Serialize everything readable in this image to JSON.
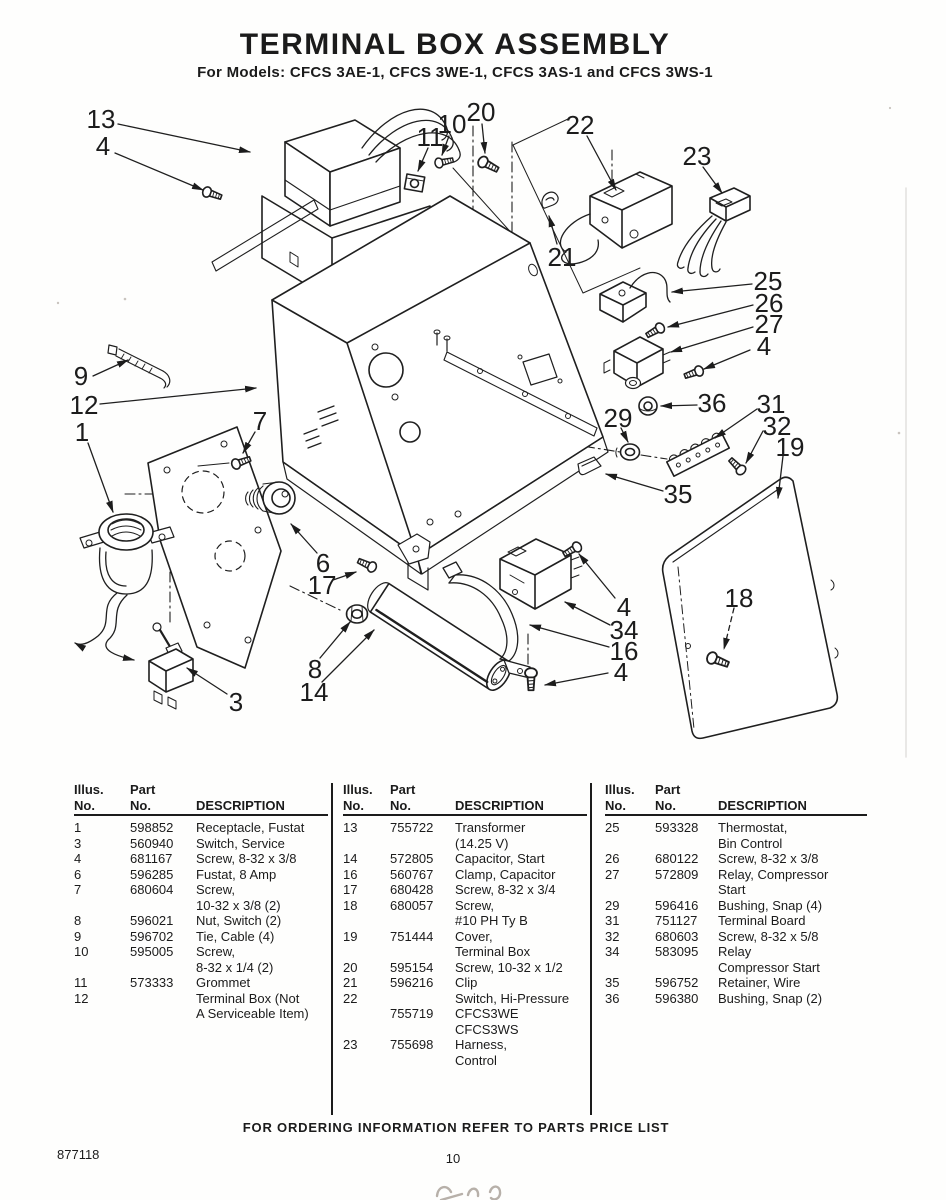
{
  "page": {
    "title": "TERMINAL BOX ASSEMBLY",
    "subtitle": "For Models: CFCS 3AE-1, CFCS 3WE-1, CFCS 3AS-1 and CFCS 3WS-1",
    "ordering_note": "FOR ORDERING INFORMATION REFER TO PARTS PRICE LIST",
    "doc_number": "877118",
    "page_number": "10"
  },
  "diagram": {
    "callouts": [
      "13",
      "4",
      "11",
      "10",
      "20",
      "22",
      "23",
      "21",
      "25",
      "26",
      "27",
      "4",
      "9",
      "12",
      "1",
      "7",
      "29",
      "36",
      "31",
      "32",
      "19",
      "35",
      "6",
      "17",
      "8",
      "14",
      "3",
      "4",
      "34",
      "16",
      "4",
      "18"
    ]
  },
  "table_headers": {
    "illus": "Illus.\nNo.",
    "part": "Part\nNo.",
    "desc": "DESCRIPTION"
  },
  "tables": [
    {
      "rows": [
        {
          "illus": "1",
          "part": "598852",
          "desc": "Receptacle, Fustat"
        },
        {
          "illus": "3",
          "part": "560940",
          "desc": "Switch, Service"
        },
        {
          "illus": "4",
          "part": "681167",
          "desc": "Screw, 8-32 x 3/8"
        },
        {
          "illus": "6",
          "part": "596285",
          "desc": "Fustat, 8 Amp"
        },
        {
          "illus": "7",
          "part": "680604",
          "desc": "Screw,\n10-32 x 3/8 (2)"
        },
        {
          "illus": "8",
          "part": "596021",
          "desc": "Nut, Switch (2)"
        },
        {
          "illus": "9",
          "part": "596702",
          "desc": "Tie, Cable (4)"
        },
        {
          "illus": "10",
          "part": "595005",
          "desc": "Screw,\n8-32 x 1/4 (2)"
        },
        {
          "illus": "11",
          "part": "573333",
          "desc": "Grommet"
        },
        {
          "illus": "12",
          "part": "",
          "desc": "Terminal Box (Not\nA Serviceable Item)"
        }
      ]
    },
    {
      "rows": [
        {
          "illus": "13",
          "part": "755722",
          "desc": "Transformer\n(14.25 V)"
        },
        {
          "illus": "14",
          "part": "572805",
          "desc": "Capacitor, Start"
        },
        {
          "illus": "16",
          "part": "560767",
          "desc": "Clamp, Capacitor"
        },
        {
          "illus": "17",
          "part": "680428",
          "desc": "Screw, 8-32 x 3/4"
        },
        {
          "illus": "18",
          "part": "680057",
          "desc": "Screw,\n#10 PH Ty B"
        },
        {
          "illus": "19",
          "part": "751444",
          "desc": "Cover,\nTerminal Box"
        },
        {
          "illus": "20",
          "part": "595154",
          "desc": "Screw, 10-32 x 1/2"
        },
        {
          "illus": "21",
          "part": "596216",
          "desc": "Clip"
        },
        {
          "illus": "22",
          "part": "",
          "desc": "Switch, Hi-Pressure"
        },
        {
          "illus": "",
          "part": "755719",
          "desc": "CFCS3WE\nCFCS3WS"
        },
        {
          "illus": "23",
          "part": "755698",
          "desc": "Harness,\nControl"
        }
      ]
    },
    {
      "rows": [
        {
          "illus": "25",
          "part": "593328",
          "desc": "Thermostat,\nBin Control"
        },
        {
          "illus": "26",
          "part": "680122",
          "desc": "Screw, 8-32 x 3/8"
        },
        {
          "illus": "27",
          "part": "572809",
          "desc": "Relay, Compressor\nStart"
        },
        {
          "illus": "29",
          "part": "596416",
          "desc": "Bushing, Snap (4)"
        },
        {
          "illus": "31",
          "part": "751127",
          "desc": "Terminal Board"
        },
        {
          "illus": "32",
          "part": "680603",
          "desc": "Screw, 8-32 x 5/8"
        },
        {
          "illus": "34",
          "part": "583095",
          "desc": "Relay\nCompressor Start"
        },
        {
          "illus": "35",
          "part": "596752",
          "desc": "Retainer, Wire"
        },
        {
          "illus": "36",
          "part": "596380",
          "desc": "Bushing, Snap (2)"
        }
      ]
    }
  ]
}
